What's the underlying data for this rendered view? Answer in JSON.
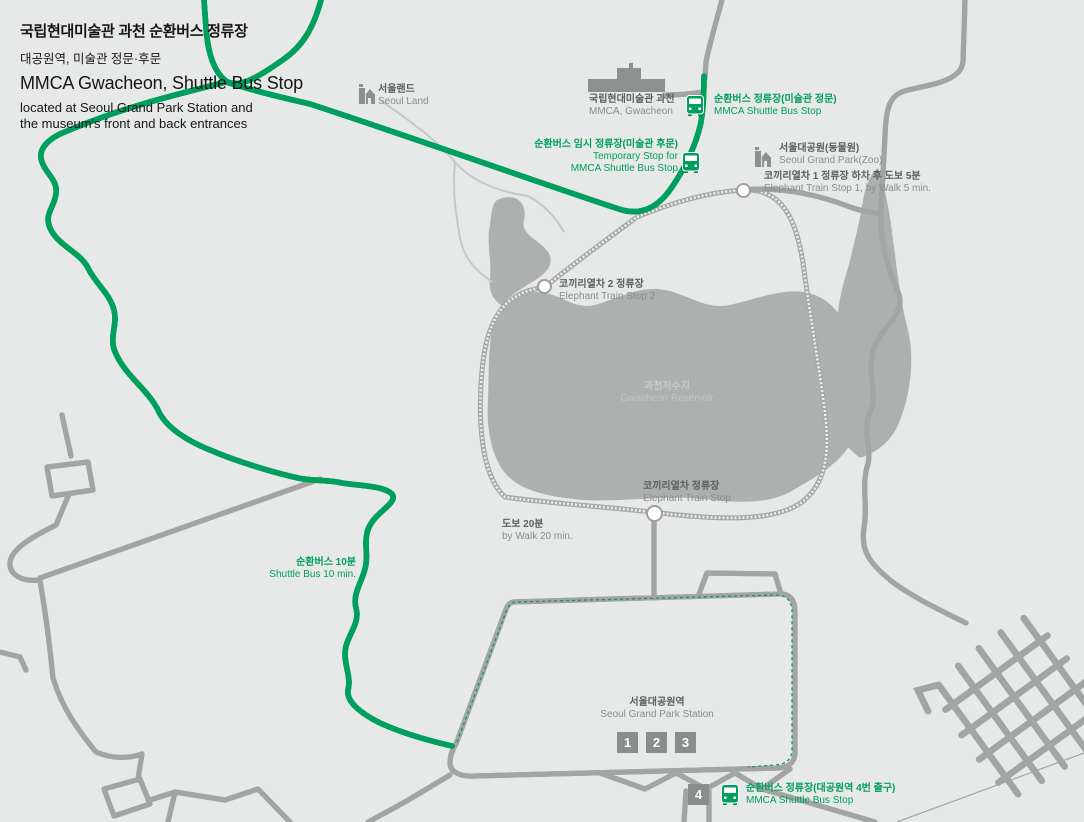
{
  "colors": {
    "green": "#00A05C",
    "background": "#E7E8E8",
    "reservoir": "#AEB0B0",
    "road_casing": "#A3A5A5",
    "label_dark": "#5C5F5F",
    "label_gray": "#8A8D8D",
    "box_gray": "#8A8D8D"
  },
  "header": {
    "title_ko": "국립현대미술관 과천 순환버스 정류장",
    "subtitle_ko": "대공원역, 미술관 정문·후문",
    "title_en": "MMCA Gwacheon, Shuttle Bus Stop",
    "description_line1": "located at Seoul Grand Park Station and",
    "description_line2": "the museum's front and back entrances"
  },
  "map": {
    "landmarks": {
      "seoul_land": {
        "ko": "서울랜드",
        "en": "Seoul Land"
      },
      "mmca": {
        "ko": "국립현대미술관 과천",
        "en": "MMCA, Gwacheon"
      },
      "zoo": {
        "ko": "서울대공원(동물원)",
        "en": "Seoul Grand Park(Zoo)"
      },
      "reservoir": {
        "ko": "과천저수지",
        "en": "Gwacheon Reservoir"
      },
      "station": {
        "ko": "서울대공원역",
        "en": "Seoul Grand Park Station"
      }
    },
    "shuttle_stops": {
      "front": {
        "ko": "순환버스 정류장(미술관 정문)",
        "en": "MMCA Shuttle Bus Stop"
      },
      "temporary": {
        "ko": "순환버스 임시 정류장(미술관 후문)",
        "en1": "Temporary Stop for",
        "en2": "MMCA Shuttle Bus Stop"
      },
      "exit4": {
        "ko": "순환버스 정류장(대공원역 4번 출구)",
        "en": "MMCA Shuttle Bus Stop"
      }
    },
    "train_stops": {
      "stop1_note": {
        "ko": "코끼리열차 1 정류장 하차 후 도보 5분",
        "en": "Elephant Train Stop 1, by Walk 5 min."
      },
      "stop2": {
        "ko": "코끼리열차 2 정류장",
        "en": "Elephant Train Stop 2"
      },
      "main": {
        "ko": "코끼리열차 정류장",
        "en": "Elephant Train Stop"
      }
    },
    "travel_notes": {
      "walk20": {
        "ko": "도보 20분",
        "en": "by Walk 20 min."
      },
      "shuttle10": {
        "ko": "순환버스 10분",
        "en": "Shuttle Bus 10 min."
      }
    },
    "exit_numbers": [
      "1",
      "2",
      "3",
      "4"
    ]
  }
}
